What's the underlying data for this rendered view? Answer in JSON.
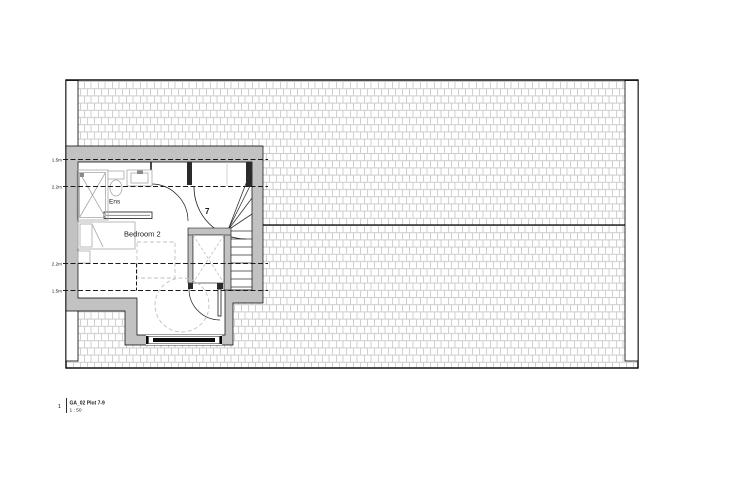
{
  "drawing": {
    "plan_labels": {
      "bedroom": "Bedroom 2",
      "ensuite": "Ens",
      "stair_riser_count": "7"
    },
    "headroom_labels": [
      {
        "text": "1.5m"
      },
      {
        "text": "2.2m"
      },
      {
        "text": "2.2m"
      },
      {
        "text": "1.5m"
      }
    ],
    "title_block": {
      "view_number": "1",
      "view_name": "GA_02 Plot 7-9",
      "scale": "1 : 50"
    },
    "colors": {
      "wall_fill": "#c2c2c2",
      "tile_hatch": "#cccccc",
      "fixture_gray": "#a9a9a9",
      "furniture_gray": "#b3b3b3",
      "dashed_zone_gray": "#bfbfbf",
      "line_black": "#1a1a1a",
      "stair_number_blue": "#2e4a7d"
    }
  }
}
